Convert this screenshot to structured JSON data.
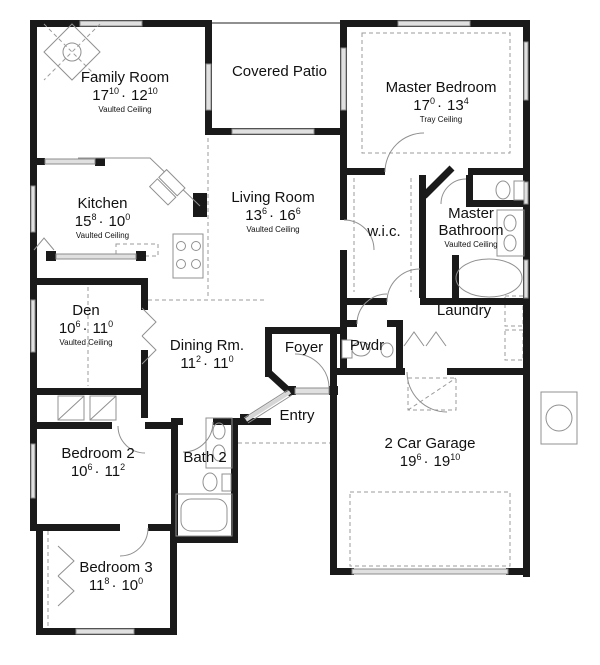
{
  "colors": {
    "wall": "#1a1a1a",
    "window_fill": "#e0e0e0",
    "window_stroke": "#8c8c8c",
    "fixture": "#909090",
    "dash": "#9b9b9b",
    "text": "#111111"
  },
  "dim_separator": "·",
  "fixtures": [
    "corner-fireplace",
    "kitchen-sink",
    "range",
    "pantry",
    "bar-counter",
    "toilet",
    "vanity-sinks",
    "bathtub",
    "washer-dryer",
    "water-heater",
    "garage-door",
    "attic-access",
    "closet-bifold-doors"
  ],
  "rooms": [
    {
      "id": "family-room",
      "name": "Family Room",
      "dim_a": "17",
      "dim_a_sup": "10",
      "dim_b": "12",
      "dim_b_sup": "10",
      "ceiling": "Vaulted Ceiling"
    },
    {
      "id": "covered-patio",
      "name": "Covered Patio"
    },
    {
      "id": "master-bedroom",
      "name": "Master Bedroom",
      "dim_a": "17",
      "dim_a_sup": "0",
      "dim_b": "13",
      "dim_b_sup": "4",
      "ceiling": "Tray Ceiling"
    },
    {
      "id": "kitchen",
      "name": "Kitchen",
      "dim_a": "15",
      "dim_a_sup": "8",
      "dim_b": "10",
      "dim_b_sup": "0",
      "ceiling": "Vaulted Ceiling"
    },
    {
      "id": "living-room",
      "name": "Living Room",
      "dim_a": "13",
      "dim_a_sup": "6",
      "dim_b": "16",
      "dim_b_sup": "6",
      "ceiling": "Vaulted Ceiling"
    },
    {
      "id": "wic",
      "name": "w.i.c."
    },
    {
      "id": "master-bathroom",
      "name": "Master Bathroom",
      "ceiling": "Vaulted Ceiling"
    },
    {
      "id": "den",
      "name": "Den",
      "dim_a": "10",
      "dim_a_sup": "6",
      "dim_b": "11",
      "dim_b_sup": "0",
      "ceiling": "Vaulted Ceiling"
    },
    {
      "id": "dining-room",
      "name": "Dining Rm.",
      "dim_a": "11",
      "dim_a_sup": "2",
      "dim_b": "11",
      "dim_b_sup": "0"
    },
    {
      "id": "foyer",
      "name": "Foyer"
    },
    {
      "id": "powder-room",
      "name": "Pwdr"
    },
    {
      "id": "laundry",
      "name": "Laundry"
    },
    {
      "id": "bedroom-2",
      "name": "Bedroom 2",
      "dim_a": "10",
      "dim_a_sup": "6",
      "dim_b": "11",
      "dim_b_sup": "2"
    },
    {
      "id": "bath-2",
      "name": "Bath 2"
    },
    {
      "id": "entry",
      "name": "Entry"
    },
    {
      "id": "garage",
      "name": "2 Car Garage",
      "dim_a": "19",
      "dim_a_sup": "6",
      "dim_b": "19",
      "dim_b_sup": "10"
    },
    {
      "id": "bedroom-3",
      "name": "Bedroom 3",
      "dim_a": "11",
      "dim_a_sup": "8",
      "dim_b": "10",
      "dim_b_sup": "0"
    }
  ]
}
